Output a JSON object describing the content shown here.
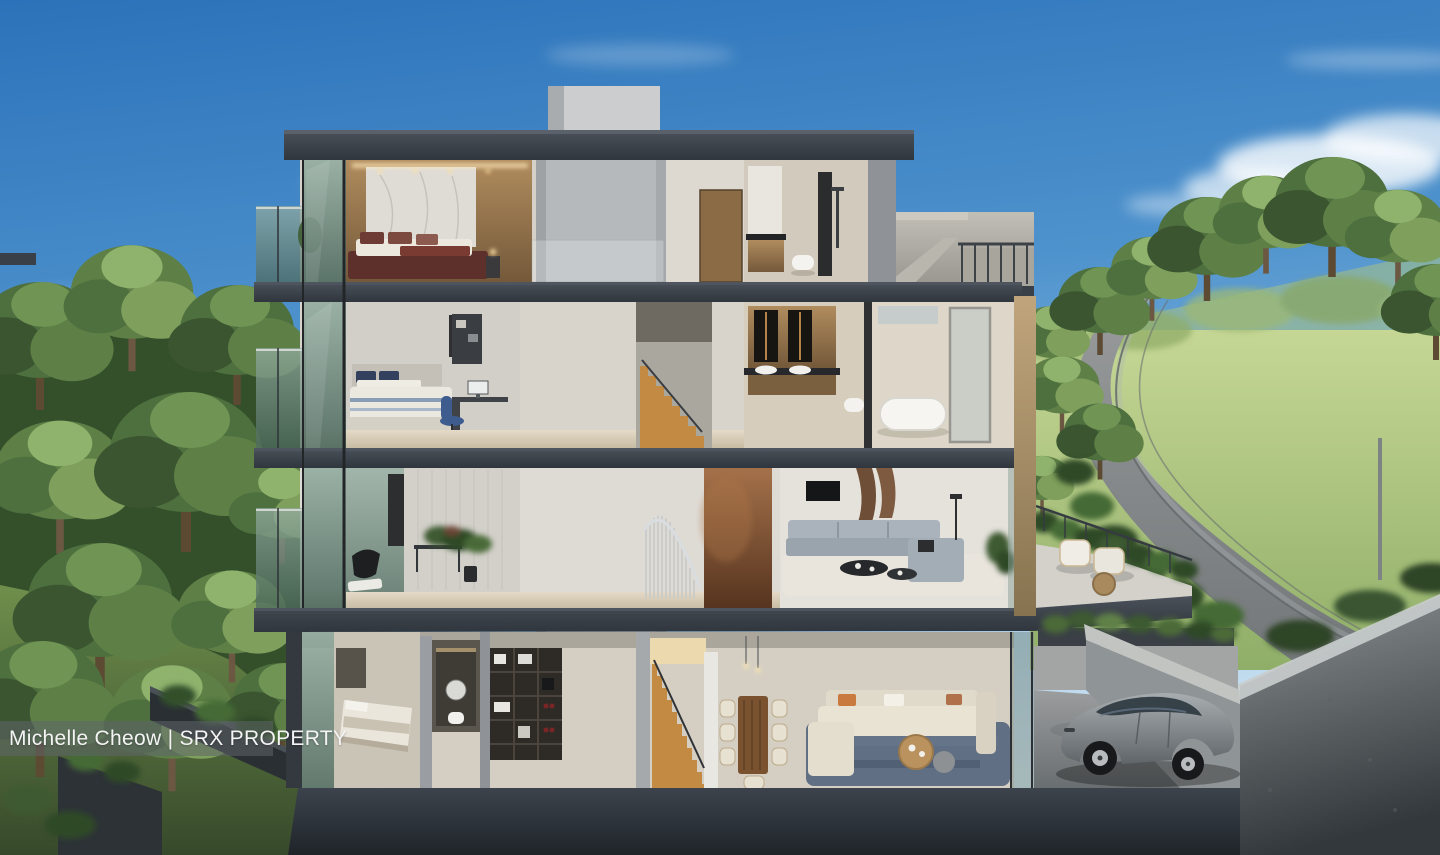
{
  "image": {
    "kind": "architectural cross-section rendering",
    "subject": "four-storey luxury residence cutaway with landscaped surroundings",
    "width_px": 1440,
    "height_px": 855
  },
  "watermark": {
    "text": "Michelle Cheow | SRX PROPERTY"
  },
  "palette": {
    "sky_top": "#2b72ba",
    "sky_horizon": "#d5e7f4",
    "slab_charcoal": "#39404a",
    "foundation": "#272c33",
    "concrete_light": "#bcb9b1",
    "concrete_mid": "#8f9397",
    "interior_wall": "#d8d4cc",
    "floor_beige": "#ddd2bd",
    "wood_panel": "#a8865a",
    "copper_wall": "#9a6a44",
    "marble": "#dfdcd6",
    "stair_wood": "#c28a42",
    "sofa_grey": "#a3adb5",
    "sofa_cream": "#e9e3d4",
    "bed_maroon": "#5d302b",
    "rug_blue": "#56677e",
    "tree_dark": "#2f4a28",
    "tree_mid": "#4e6f3e",
    "tree_light": "#7fa05c",
    "grass": "#8fae68",
    "road": "#989da0",
    "car_grey": "#85898c",
    "glass_tint": "#8fa89b",
    "watermark_bg": "rgba(95,100,105,0.55)",
    "watermark_text": "#f4f4f4"
  },
  "scene": {
    "sky": "blue gradient sky with soft white clouds",
    "floors": [
      {
        "level": 4,
        "rooms": [
          "master-bedroom with marble headboard wall and bed",
          "elevator",
          "corridor",
          "bathroom with shower and wall-hung toilet"
        ]
      },
      {
        "level": 3,
        "rooms": [
          "bedroom with desk and computer",
          "elevator",
          "timber staircase",
          "double-vanity bathroom",
          "freestanding bathtub room"
        ]
      },
      {
        "level": 2,
        "rooms": [
          "study-lounge with plants and black chair",
          "elevator",
          "spiral staircase with copper feature wall",
          "living room with grey sofa",
          "roof terrace with white armchairs"
        ]
      },
      {
        "level": 1,
        "rooms": [
          "guest bedroom",
          "powder room",
          "storage shelving",
          "elevator",
          "timber staircase",
          "dining room with wooden table",
          "family living room with cream sectional on blue rug",
          "driveway with grey sedan"
        ]
      }
    ],
    "landscape": [
      "dense forest on the left slope",
      "treeline on the right",
      "winding grey road climbing the hill",
      "dark retaining walls with planters",
      "concrete boundary wall at bottom right",
      "grey electric sedan parked in driveway"
    ]
  }
}
